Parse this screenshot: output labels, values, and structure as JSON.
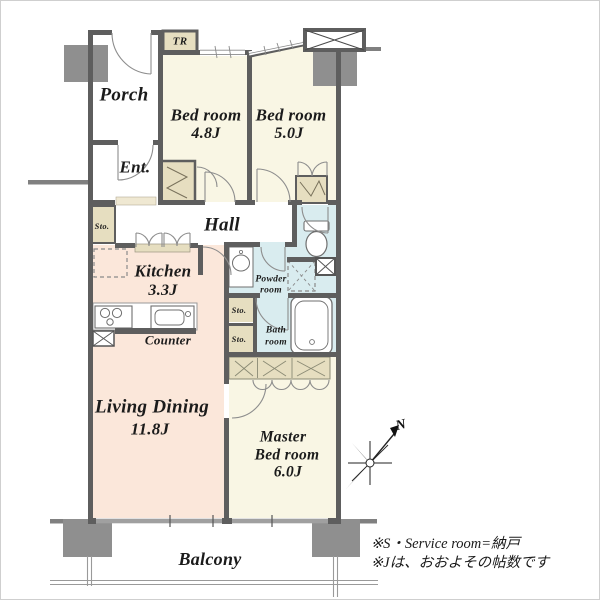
{
  "plan": {
    "rooms": {
      "porch": {
        "label": "Porch"
      },
      "entrance": {
        "label": "Ent."
      },
      "trunk_room": {
        "label": "TR"
      },
      "bedroom1": {
        "label": "Bed room",
        "size": "4.8J"
      },
      "bedroom2": {
        "label": "Bed room",
        "size": "5.0J"
      },
      "hall": {
        "label": "Hall"
      },
      "kitchen": {
        "label": "Kitchen",
        "size": "3.3J"
      },
      "counter": {
        "label": "Counter"
      },
      "living_dining": {
        "label": "Living Dining",
        "size": "11.8J"
      },
      "master_bedroom": {
        "label_line1": "Master",
        "label_line2": "Bed room",
        "size": "6.0J"
      },
      "powder_room": {
        "label_line1": "Powder",
        "label_line2": "room"
      },
      "bath_room": {
        "label_line1": "Bath",
        "label_line2": "room"
      },
      "storage_entry": {
        "label": "Sto."
      },
      "storage_upper": {
        "label": "Sto."
      },
      "storage_lower": {
        "label": "Sto."
      },
      "balcony": {
        "label": "Balcony"
      }
    },
    "compass": {
      "north_label": "N"
    },
    "notes": {
      "line1": "※S・Service room=納戸",
      "line2": "※Jは、おおよその帖数です"
    },
    "colors": {
      "wall": "#5e5e5e",
      "pillar": "#8f8f8f",
      "bedroom_floor": "#f9f6e4",
      "living_floor": "#fbe7da",
      "wet_floor": "#d9ecef",
      "closet_fill": "#e6dec0",
      "window": "#a0a0a0",
      "text": "#1b1b1b"
    }
  }
}
